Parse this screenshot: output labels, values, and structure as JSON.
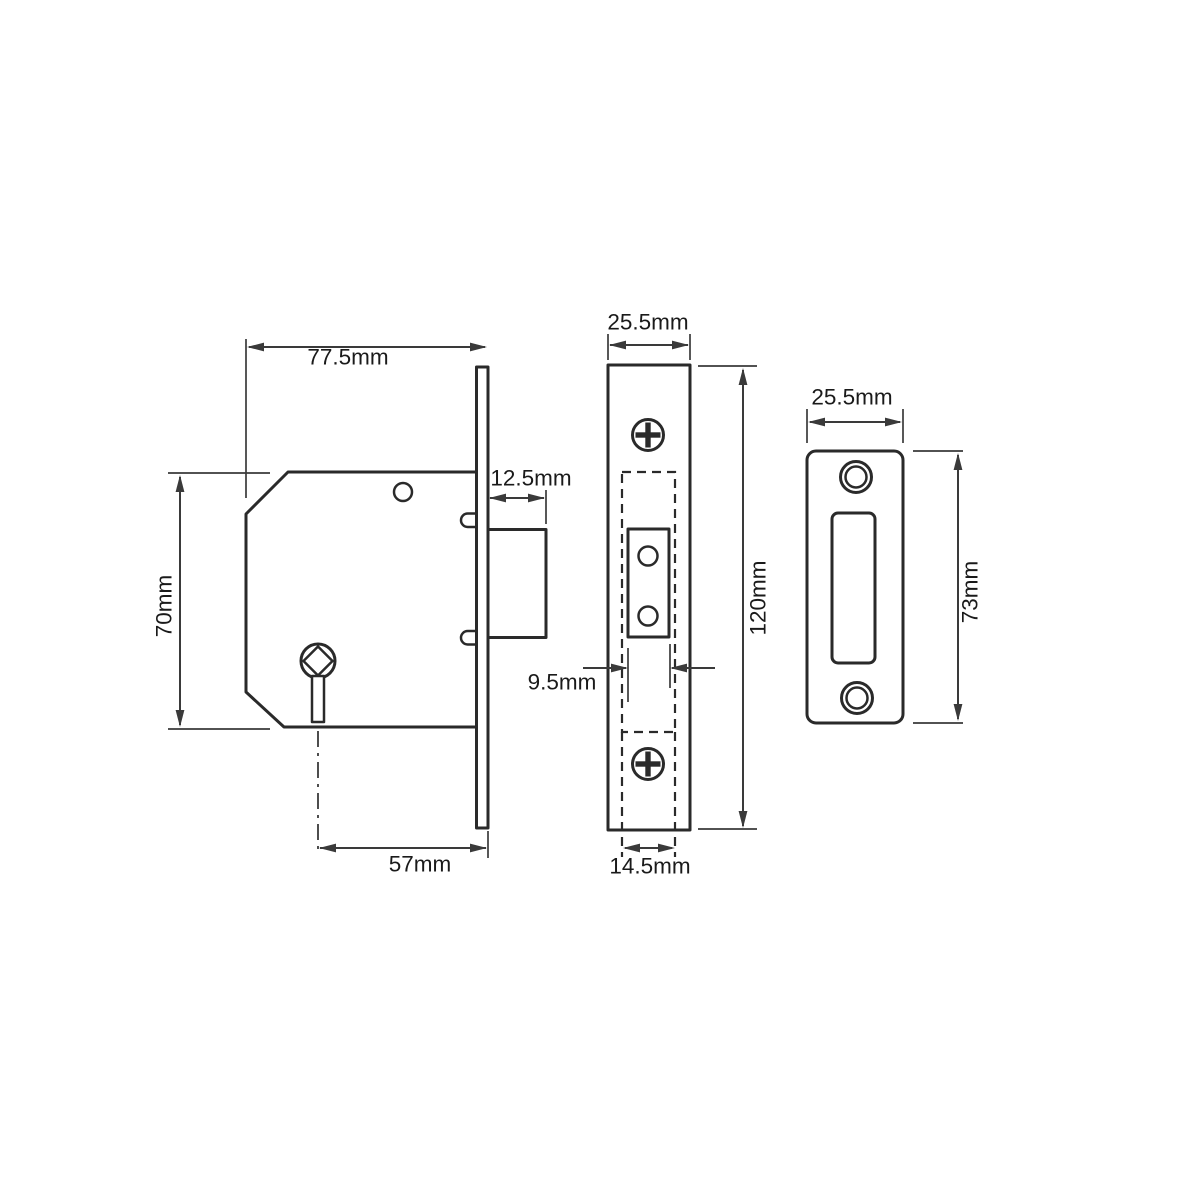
{
  "colors": {
    "bg": "#ffffff",
    "line": "#2a2a2a",
    "dim": "#3a3a3a",
    "text": "#1a1a1a"
  },
  "drawing": {
    "type": "technical-dimension-diagram",
    "subject": "mortice-deadlock",
    "side_view": {
      "dims": {
        "body_width": "77.5mm",
        "bolt_throw": "12.5mm",
        "body_height": "70mm",
        "backset": "57mm"
      }
    },
    "faceplate_view": {
      "dims": {
        "plate_width": "25.5mm",
        "plate_height": "120mm",
        "bolt_width": "9.5mm",
        "case_width": "14.5mm"
      }
    },
    "strike_plate_view": {
      "dims": {
        "plate_width": "25.5mm",
        "plate_height": "73mm"
      }
    }
  }
}
